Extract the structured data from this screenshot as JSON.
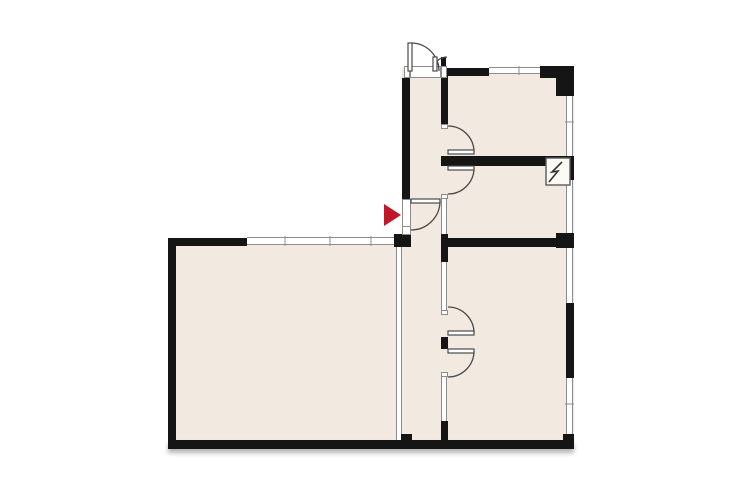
{
  "app": {
    "type": "architectural-floor-plan",
    "visible_text": ""
  },
  "colors": {
    "background": "#ffffff",
    "floor": "#f2eae1",
    "wall": "#151515",
    "thin_line": "#8d8d8d",
    "window_line": "#8d8d8d",
    "door_line": "#4a4a4a",
    "accent_red": "#c0182a",
    "panel_fill": "#fbfaf7",
    "panel_border": "#5a5a5a"
  },
  "plan": {
    "shape": "L-shaped apartment plan",
    "rooms": [
      {
        "id": "large-room-bottom-left"
      },
      {
        "id": "hallway-center-vertical"
      },
      {
        "id": "room-top-right"
      },
      {
        "id": "room-middle-right"
      },
      {
        "id": "room-bottom-right"
      }
    ],
    "doors": [
      {
        "id": "main-entrance-door",
        "wall": "hallway-left",
        "marker": "red-triangle"
      },
      {
        "id": "double-door-top",
        "wall": "top-exterior",
        "leaves": 2
      },
      {
        "id": "door-room-top-right",
        "wall": "hallway-right"
      },
      {
        "id": "door-room-middle-right",
        "wall": "hallway-right"
      },
      {
        "id": "door-room-bottom-right-upper",
        "wall": "hallway-right"
      },
      {
        "id": "door-room-bottom-right-lower",
        "wall": "hallway-right"
      }
    ],
    "windows": [
      {
        "id": "window-top-exterior"
      },
      {
        "id": "window-right-1"
      },
      {
        "id": "window-right-2"
      },
      {
        "id": "window-right-3"
      },
      {
        "id": "window-right-4"
      },
      {
        "id": "window-large-room-top"
      }
    ],
    "symbols": [
      {
        "id": "entrance-marker",
        "icon": "red-triangle-icon"
      },
      {
        "id": "electrical-panel",
        "icon": "lightning-bolt-icon"
      }
    ]
  }
}
